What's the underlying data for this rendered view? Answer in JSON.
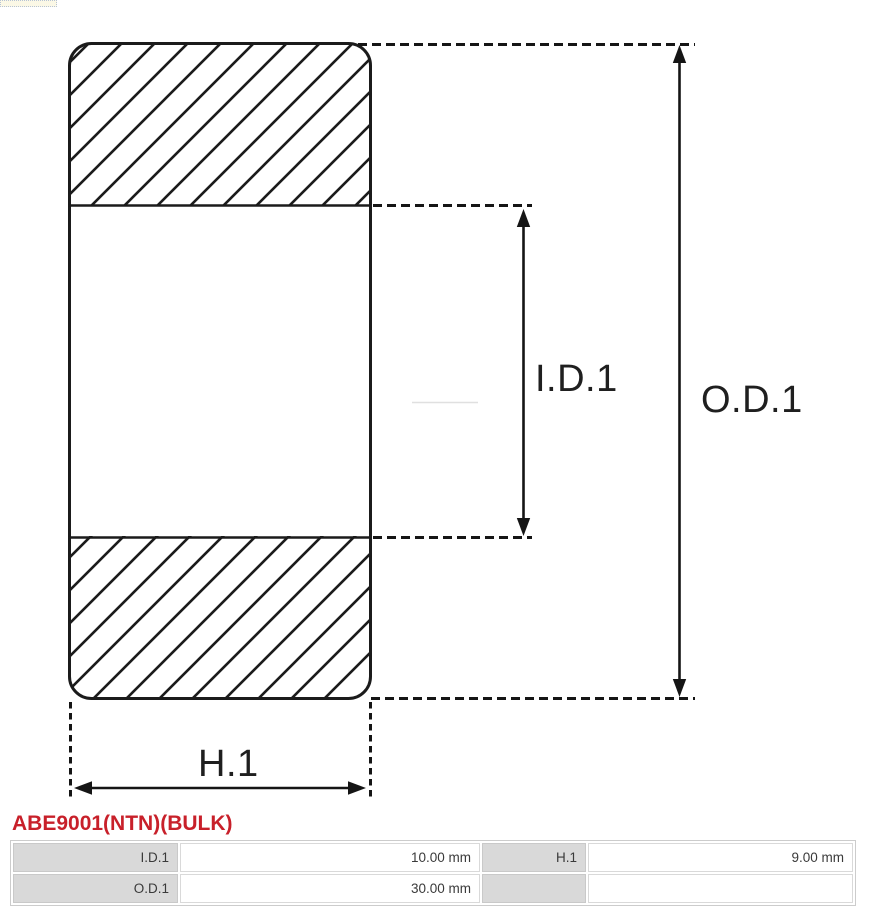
{
  "diagram": {
    "inner_diameter_label": "I.D.1",
    "outer_diameter_label": "O.D.1",
    "width_label": "H.1"
  },
  "part": {
    "number": "ABE9001(NTN)(BULK)"
  },
  "spec_table": {
    "rows": [
      {
        "cells": [
          {
            "label": "I.D.1",
            "value": "10.00 mm"
          },
          {
            "label": "H.1",
            "value": "9.00 mm"
          }
        ]
      },
      {
        "cells": [
          {
            "label": "O.D.1",
            "value": "30.00 mm"
          },
          {
            "label": "",
            "value": ""
          }
        ]
      }
    ]
  },
  "colors": {
    "accent_red": "#c8202a",
    "line_black": "#1b1b1b",
    "table_label_bg": "#d9d9d9"
  }
}
